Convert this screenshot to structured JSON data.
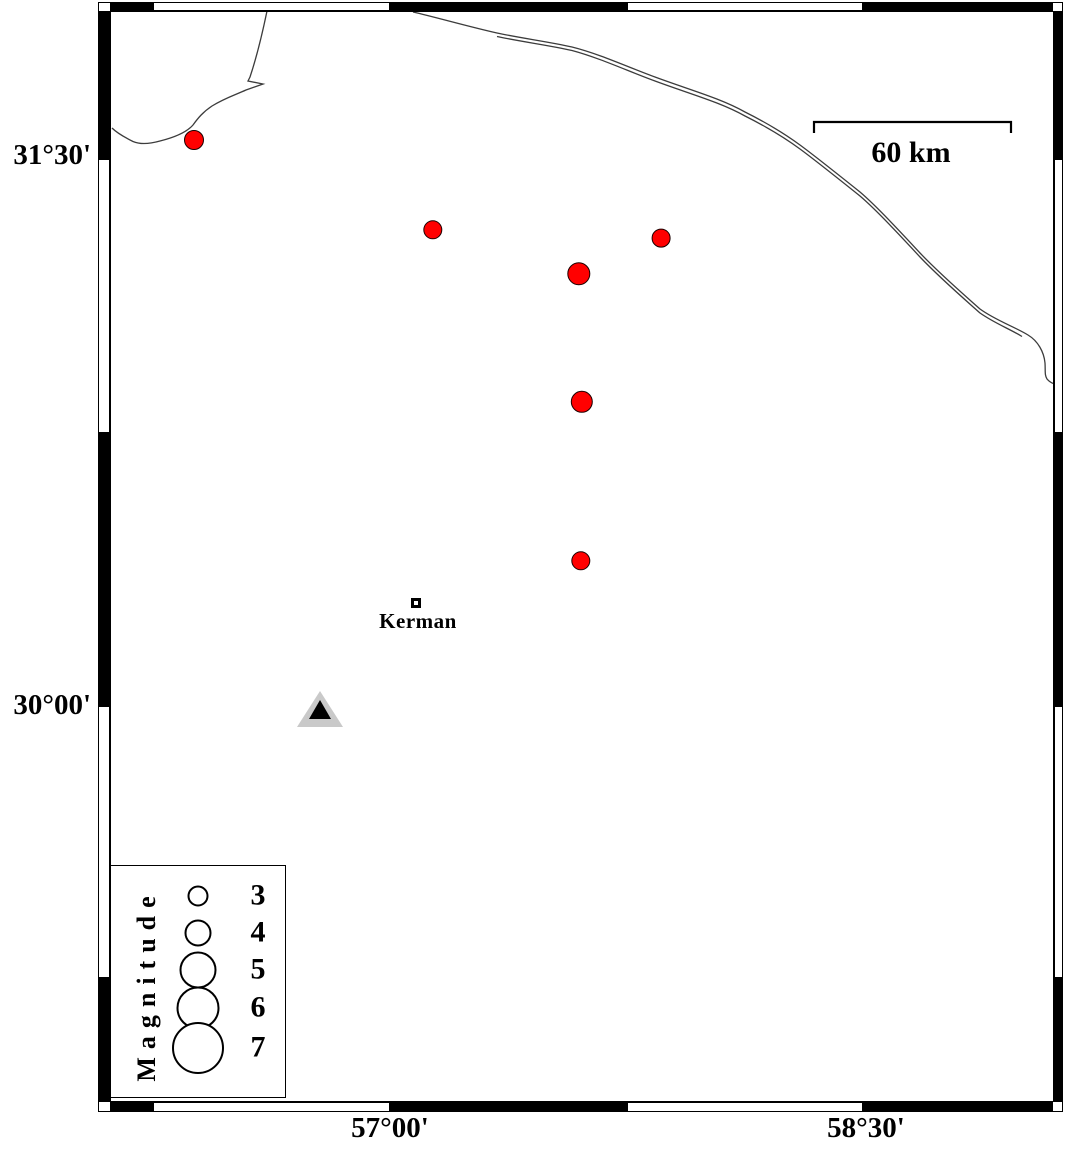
{
  "frame": {
    "lat_ticks": [
      {
        "label": "31°30'",
        "y": 156
      },
      {
        "label": "30°00'",
        "y": 706
      }
    ],
    "lon_ticks": [
      {
        "label": "57°00'",
        "x": 390
      },
      {
        "label": "58°30'",
        "x": 866
      }
    ]
  },
  "scale_bar": {
    "label": "60 km",
    "x1": 814,
    "x2": 1011,
    "y": 122
  },
  "city": {
    "label": "Kerman",
    "x": 416,
    "y": 603
  },
  "station": {
    "x": 320,
    "y": 712
  },
  "earthquakes": [
    {
      "x": 194,
      "y": 140,
      "r": 10.0
    },
    {
      "x": 433,
      "y": 230,
      "r": 9.7
    },
    {
      "x": 661,
      "y": 238,
      "r": 9.4
    },
    {
      "x": 579,
      "y": 274,
      "r": 11.7
    },
    {
      "x": 582,
      "y": 402,
      "r": 11.2
    },
    {
      "x": 581,
      "y": 561,
      "r": 9.7
    }
  ],
  "legend": {
    "title": "Magnitude",
    "circle_x": 198,
    "value_x": 258,
    "entries": [
      {
        "label": "3",
        "y": 896,
        "r": 10.5
      },
      {
        "label": "4",
        "y": 933,
        "r": 13.5
      },
      {
        "label": "5",
        "y": 970,
        "r": 18.5
      },
      {
        "label": "6",
        "y": 1008,
        "r": 21.5
      },
      {
        "label": "7",
        "y": 1048,
        "r": 26.0
      }
    ]
  },
  "colors": {
    "earthquake_fill": "#ff0000",
    "station_fill": "#c9c9c9",
    "station_inner": "#000000",
    "line": "#3c3c3c"
  }
}
